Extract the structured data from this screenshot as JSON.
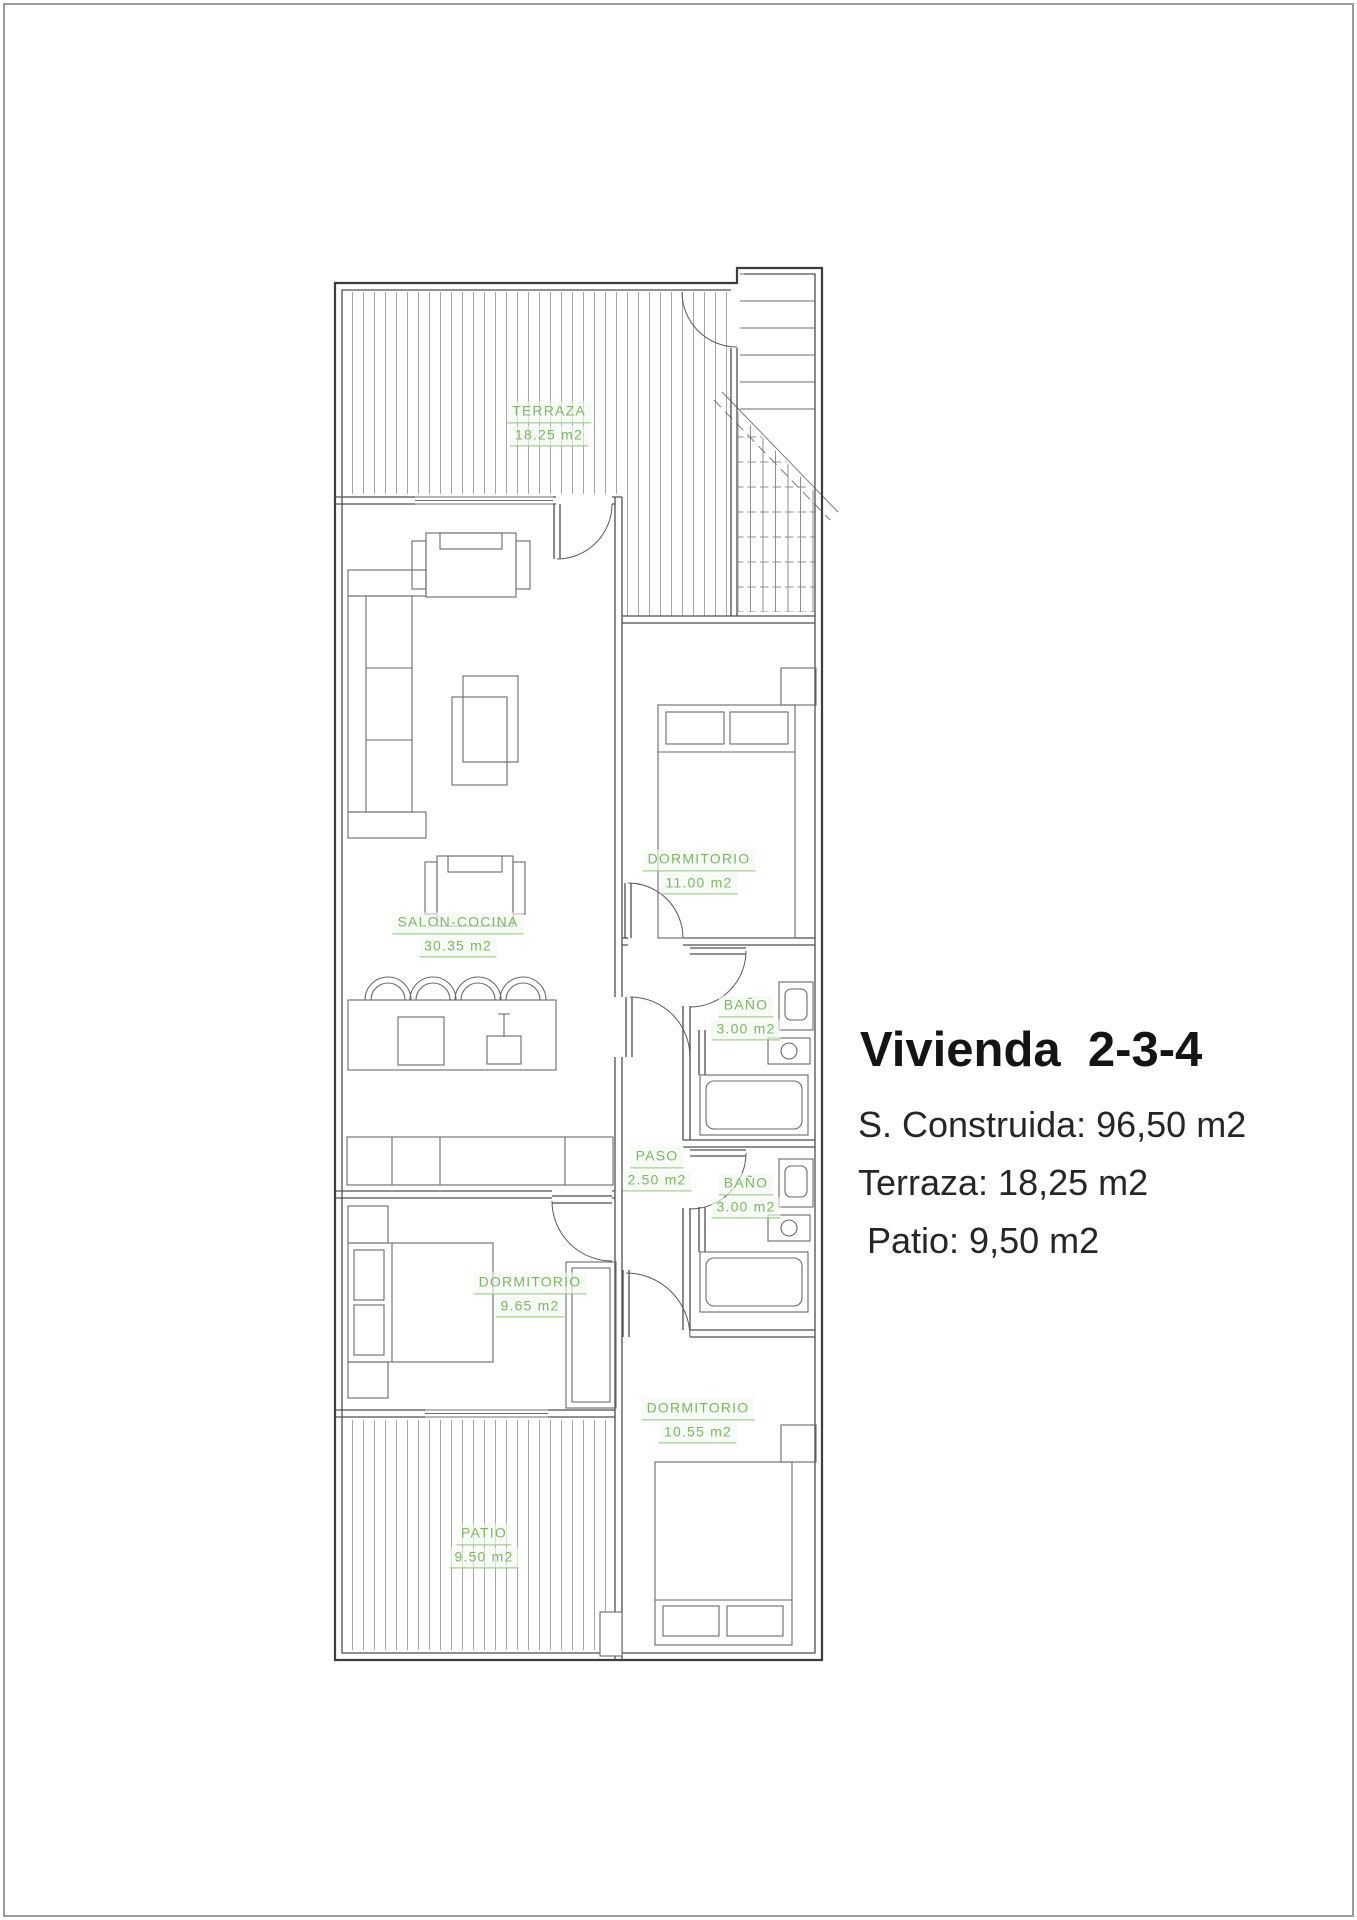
{
  "page": {
    "background": "#ffffff",
    "border_color": "#9c9c9c"
  },
  "info_panel": {
    "title": "Vivienda  2-3-4",
    "area_lines": [
      "S. Construida: 96,50 m2",
      "Terraza: 18,25 m2",
      "Patio: 9,50 m2"
    ]
  },
  "room_labels": [
    {
      "name": "TERRAZA",
      "area": "18.25 m2"
    },
    {
      "name": "SALON-COCINA",
      "area": "30.35 m2"
    },
    {
      "name": "DORMITORIO",
      "area": "11.00 m2"
    },
    {
      "name": "BAÑO",
      "area": "3.00 m2"
    },
    {
      "name": "PASO",
      "area": "2.50 m2"
    },
    {
      "name": "BAÑO",
      "area": "3.00 m2"
    },
    {
      "name": "DORMITORIO",
      "area": "9.65 m2"
    },
    {
      "name": "DORMITORIO",
      "area": "10.55 m2"
    },
    {
      "name": "PATIO",
      "area": "9.50 m2"
    }
  ],
  "colors": {
    "label_green": "#7cb85f",
    "wall_dark": "#3d3d3d",
    "wall_light": "#4f4f4f",
    "hatch_grey": "#a6a6a6",
    "title_text": "#141414"
  }
}
